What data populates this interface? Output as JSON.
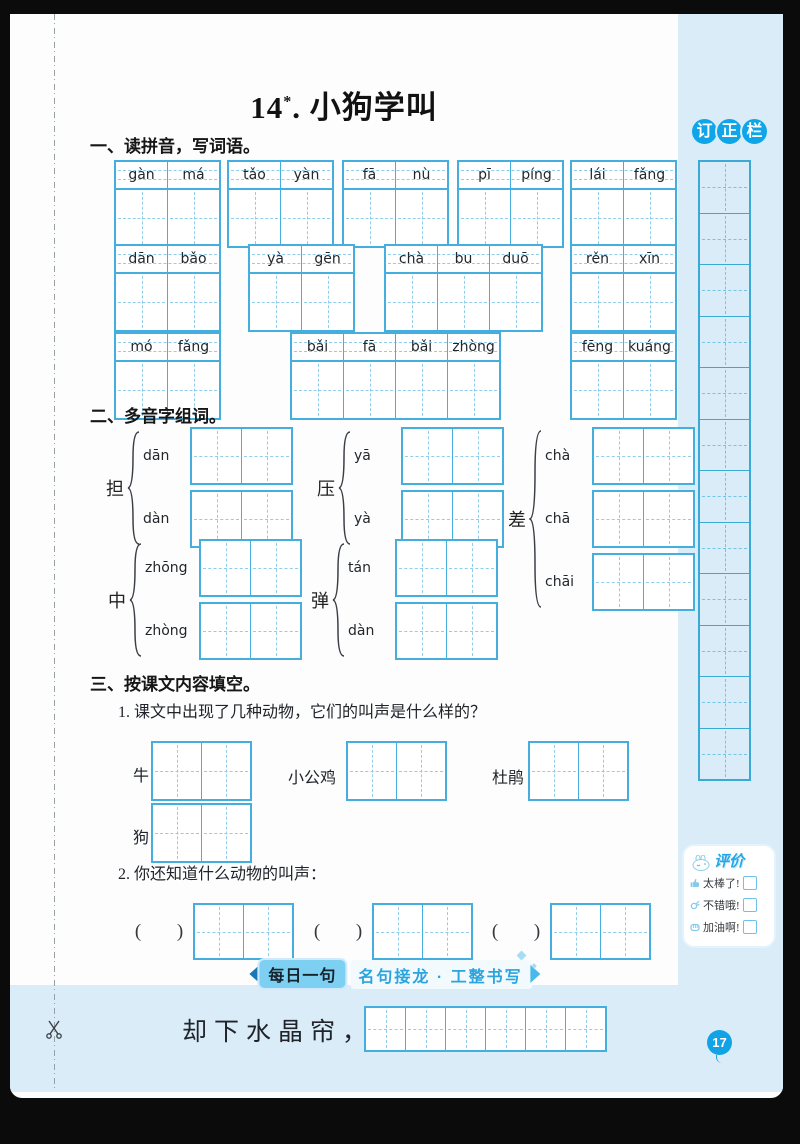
{
  "title": {
    "num": "14",
    "star": "*",
    "rest": ". 小狗学叫"
  },
  "sections": {
    "s1": {
      "heading": "一、读拼音，写词语。",
      "rows": [
        [
          [
            "gàn",
            "má"
          ],
          [
            "tǎo",
            "yàn"
          ],
          [
            "fā",
            "nù"
          ],
          [
            "pī",
            "píng"
          ],
          [
            "lái",
            "fǎng"
          ]
        ],
        [
          [
            "dān",
            "bǎo"
          ],
          [
            "yà",
            "gēn"
          ],
          [
            "chà",
            "bu",
            "duō"
          ],
          [
            "rěn",
            "xīn"
          ]
        ],
        [
          [
            "mó",
            "fǎng"
          ],
          [
            "bǎi",
            "fā",
            "bǎi",
            "zhòng"
          ],
          [
            "fēng",
            "kuáng"
          ]
        ]
      ]
    },
    "s2": {
      "heading": "二、多音字组词。",
      "groups": [
        {
          "char": "担",
          "readings": [
            "dān",
            "dàn"
          ]
        },
        {
          "char": "压",
          "readings": [
            "yā",
            "yà"
          ]
        },
        {
          "char": "差",
          "readings": [
            "chà",
            "chā",
            "chāi"
          ]
        },
        {
          "char": "中",
          "readings": [
            "zhōng",
            "zhòng"
          ]
        },
        {
          "char": "弹",
          "readings": [
            "tán",
            "dàn"
          ]
        }
      ]
    },
    "s3": {
      "heading": "三、按课文内容填空。",
      "q1": "1. 课文中出现了几种动物，它们的叫声是什么样的？",
      "q1_items": [
        "牛",
        "小公鸡",
        "杜鹃",
        "狗"
      ],
      "q2": "2. 你还知道什么动物的叫声：",
      "paren_open": "(",
      "paren_close": ")"
    }
  },
  "correction": {
    "chars": [
      "订",
      "正",
      "栏"
    ],
    "cells": 12
  },
  "evaluation": {
    "title": "评价",
    "items": [
      "太棒了!",
      "不错哦!",
      "加油啊!"
    ]
  },
  "footer": {
    "tab": "每日一句",
    "subtitle": "名句接龙 · 工整书写",
    "sentence": "却下水晶帘，",
    "write_cells": 6
  },
  "page_number": "17",
  "colors": {
    "grid": "#44aede",
    "grid_dash": "#8fcdeb",
    "bg_blue": "#d9ecf8",
    "accent": "#12a2e6"
  }
}
